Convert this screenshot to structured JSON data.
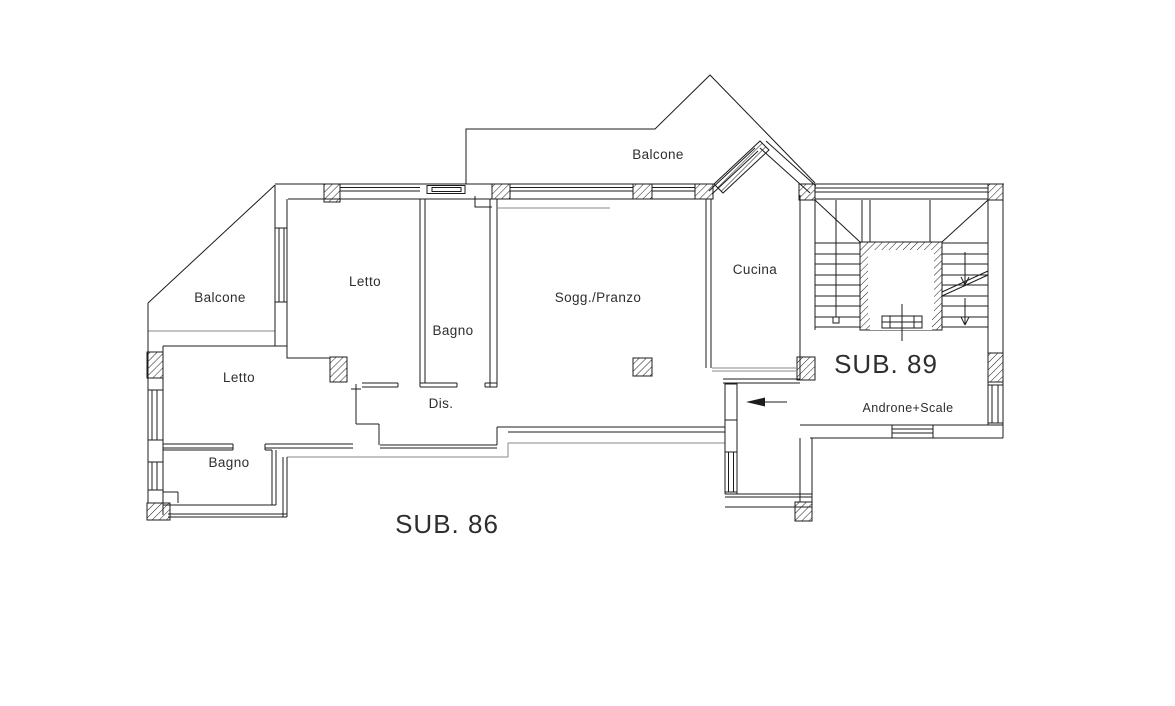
{
  "plan": {
    "labels": {
      "balcone_top": "Balcone",
      "balcone_left": "Balcone",
      "letto_top": "Letto",
      "bagno_top": "Bagno",
      "sogg_pranzo": "Sogg./Pranzo",
      "cucina": "Cucina",
      "letto_lower": "Letto",
      "dis": "Dis.",
      "bagno_lower": "Bagno"
    },
    "units": {
      "sub86": "SUB. 86",
      "sub89": "SUB. 89",
      "androne_scale": "Androne+Scale"
    },
    "colors": {
      "wall_line": "#1c1c1c",
      "thin_line": "#8a8a8a",
      "text": "#2e2e2e",
      "background": "#ffffff"
    }
  }
}
